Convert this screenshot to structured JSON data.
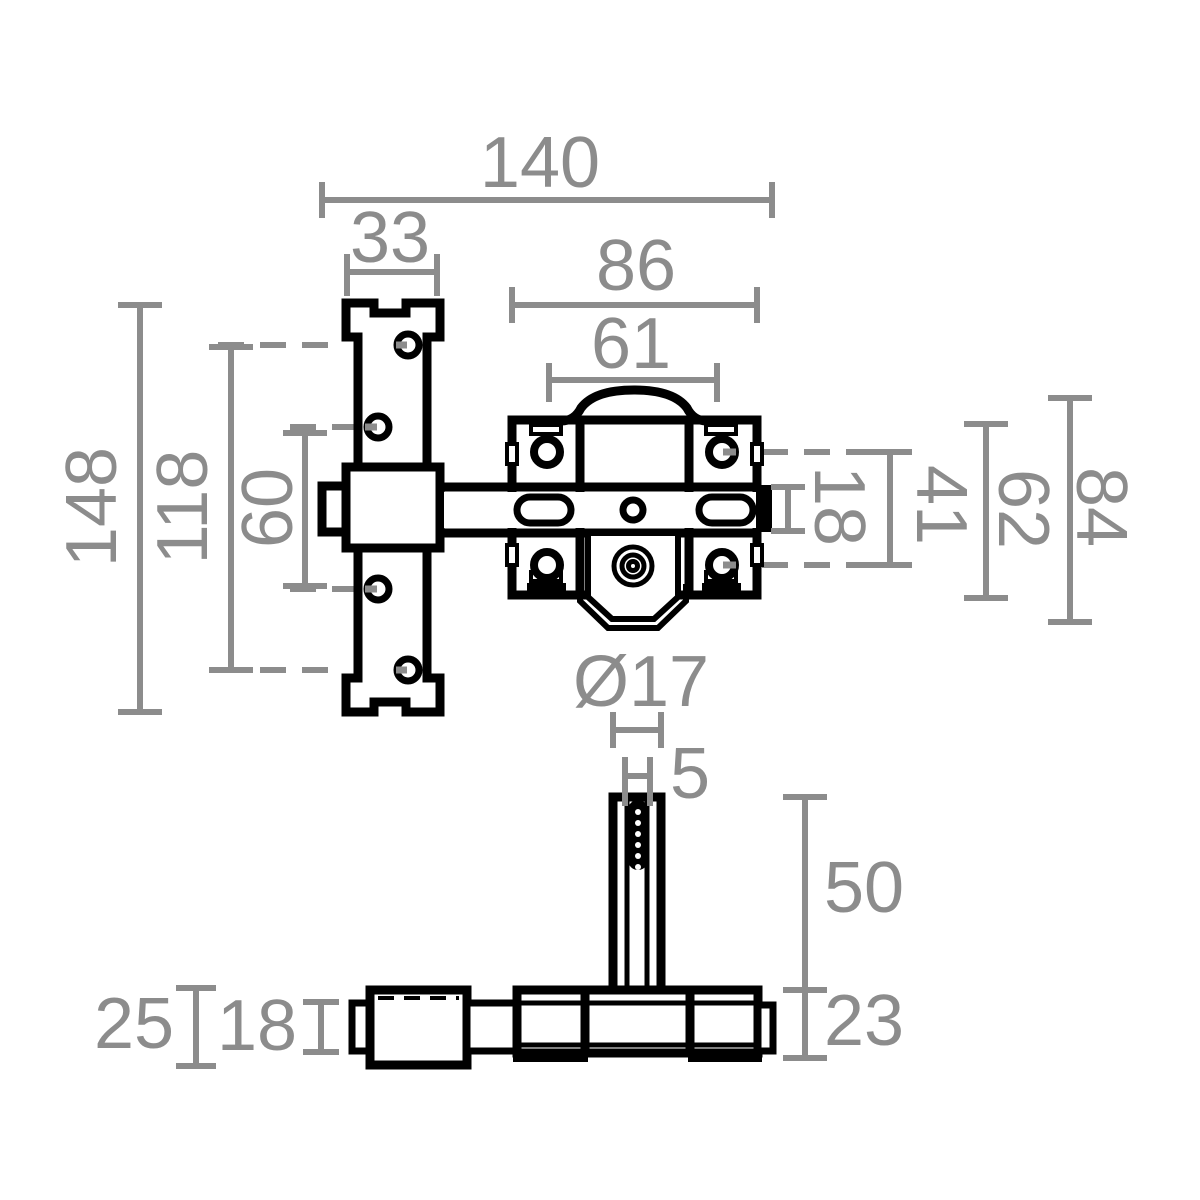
{
  "colors": {
    "background": "#ffffff",
    "part_line": "#000000",
    "dimension": "#8c8c8c"
  },
  "views": {
    "top": {
      "dimensions": {
        "total_width": "140",
        "keeper_width": "33",
        "body_width": "86",
        "arch_width": "61",
        "keeper_height": "148",
        "outer_hole_spacing": "118",
        "inner_hole_spacing": "60",
        "bolt_thickness": "18",
        "hole_row_spacing": "41",
        "body_height": "62",
        "overall_height": "84"
      }
    },
    "front": {
      "dimensions": {
        "rod_diameter": "Ø17",
        "slot_width": "5",
        "rod_length": "50",
        "body_depth": "23",
        "keeper_depth": "25",
        "bar_depth": "18"
      }
    }
  }
}
